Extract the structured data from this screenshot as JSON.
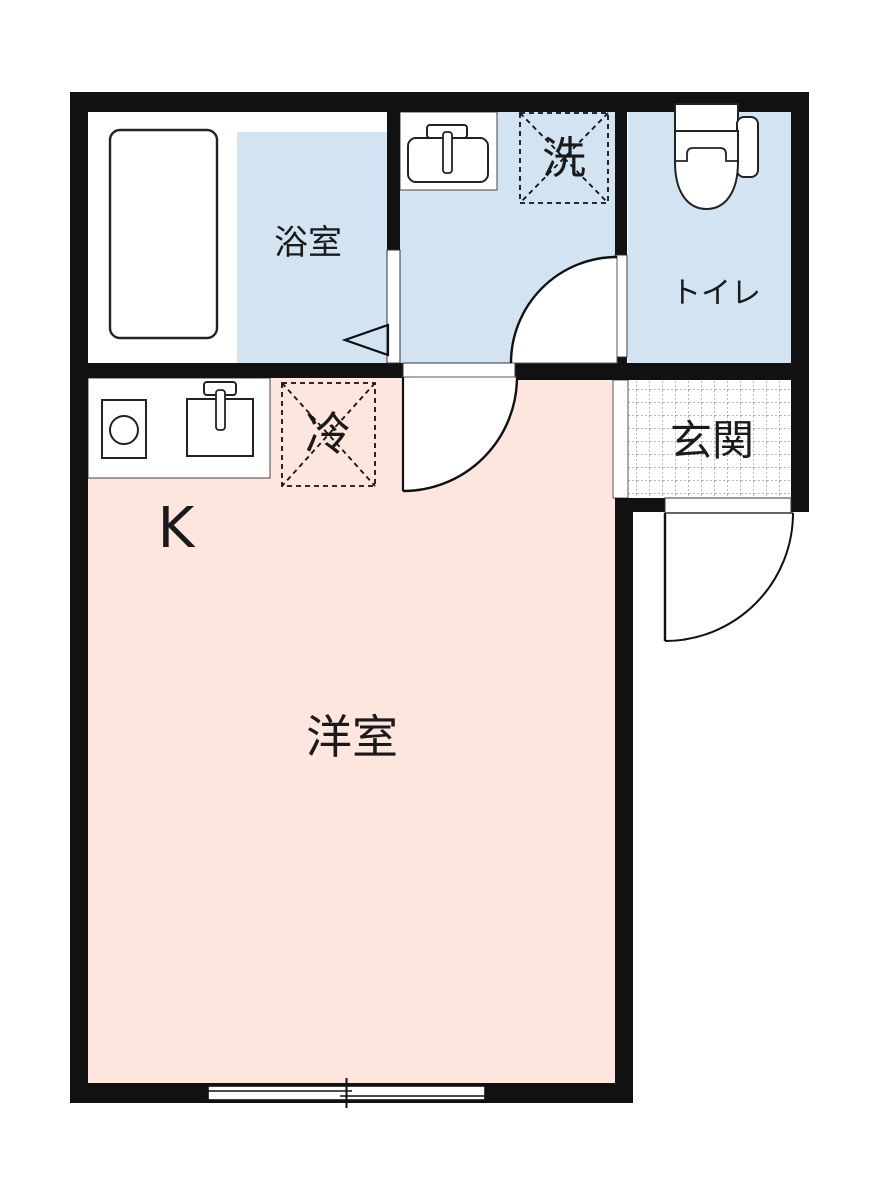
{
  "floorplan": {
    "colors": {
      "wall": "#111111",
      "wet_area_fill": "#d2e4f2",
      "living_area_fill": "#fce6de",
      "fixture_fill": "#ffffff",
      "outline": "#333333",
      "text": "#1a1a1a",
      "tile_line": "#777777"
    },
    "rooms": {
      "bathroom": {
        "label": "浴室"
      },
      "toilet": {
        "label": "トイレ"
      },
      "entrance": {
        "label": "玄関"
      },
      "kitchen": {
        "label": "K"
      },
      "western_room": {
        "label": "洋室"
      }
    },
    "markers": {
      "washing_machine_space": {
        "label": "洗"
      },
      "refrigerator_space": {
        "label": "冷"
      }
    },
    "icons": [
      "bathtub-icon",
      "washbasin-icon",
      "toilet-bowl-icon",
      "stove-icon",
      "kitchen-sink-icon",
      "folding-door-marker-icon",
      "door-swing-icon",
      "sliding-window-icon",
      "entrance-tile-floor"
    ]
  }
}
